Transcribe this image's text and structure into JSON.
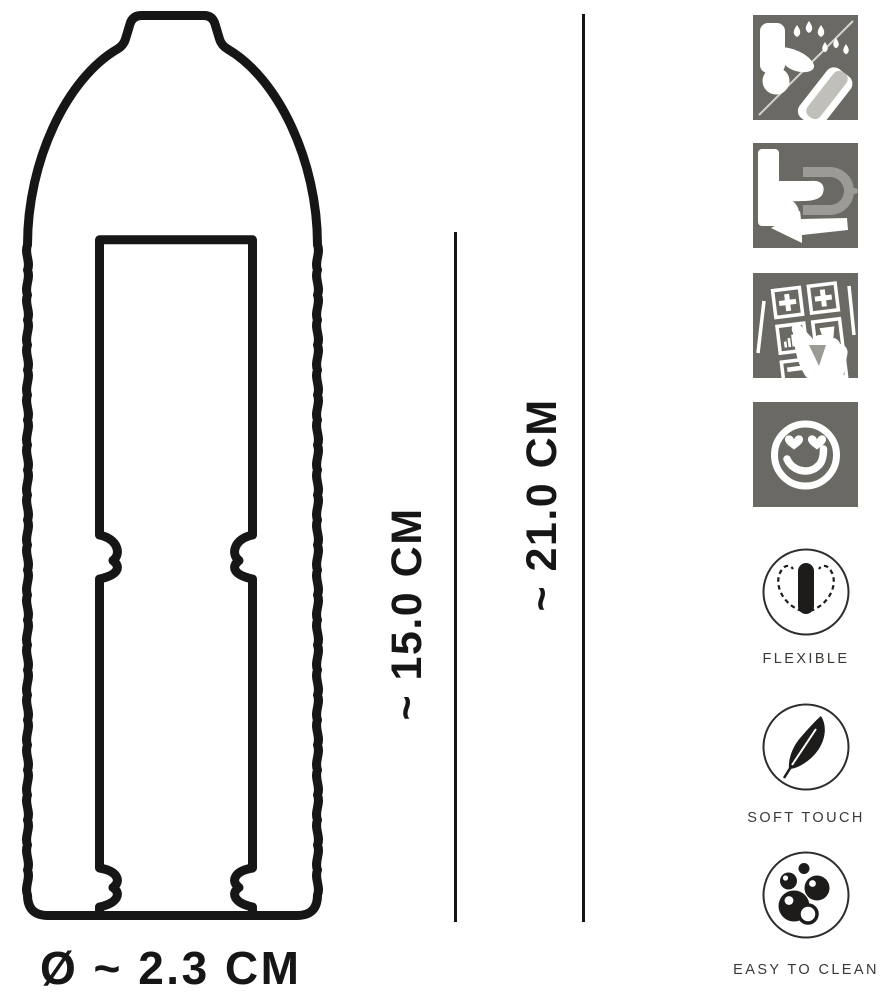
{
  "diagram": {
    "dimension_inner_length": "~ 15.0 CM",
    "dimension_total_length": "~ 21.0 CM",
    "dimension_diameter": "Ø ~ 2.3 CM"
  },
  "instruction_icons": [
    {
      "icon": "lubricant-compatible-icon"
    },
    {
      "icon": "slide-on-sleeve-icon"
    },
    {
      "icon": "selection-panel-icon"
    },
    {
      "icon": "smiley-heart-eyes-icon"
    }
  ],
  "features": [
    {
      "icon": "flexible-icon",
      "label": "FLEXIBLE"
    },
    {
      "icon": "feather-icon",
      "label": "SOFT TOUCH"
    },
    {
      "icon": "bubbles-icon",
      "label": "EASY TO CLEAN"
    }
  ],
  "colors": {
    "line_art": "#161616",
    "icon_tile_background": "#6a6963",
    "icon_accent_light": "#c0bfb9",
    "label_text": "#3a3936"
  }
}
